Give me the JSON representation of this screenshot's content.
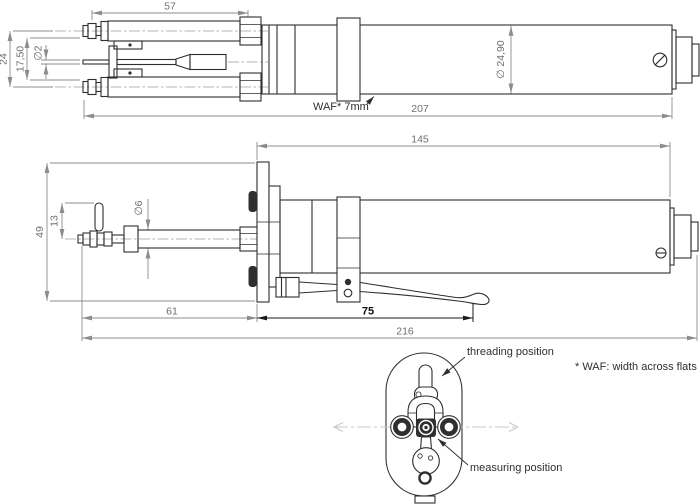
{
  "views": {
    "side_top": {
      "dims": {
        "head_length": "57",
        "height_overall": "24",
        "height_inner": "17,50",
        "stylus_diameter": "∅2",
        "body_diameter": "∅ 24,90",
        "total_length": "207",
        "wrench_note": "WAF* 7mm"
      }
    },
    "side_clamped": {
      "dims": {
        "body_length": "145",
        "flange_height": "49",
        "pin_offset": "13",
        "spindle_diameter": "∅6",
        "tip_to_flange": "61",
        "flange_to_lever": "75",
        "total_length": "216"
      }
    },
    "front": {
      "labels": {
        "threading_position": "threading position",
        "measuring_position": "measuring position"
      }
    }
  },
  "footnote": "* WAF: width across flats",
  "colors": {
    "object_line": "#2f2f2f",
    "dimension_line": "#8c8c8c",
    "dimension_text": "#6f6f6f",
    "label_text": "#2f2f2f",
    "centerline": "#9aa0a0",
    "motion_arrow": "#c9c9c9",
    "background": "#ffffff"
  }
}
